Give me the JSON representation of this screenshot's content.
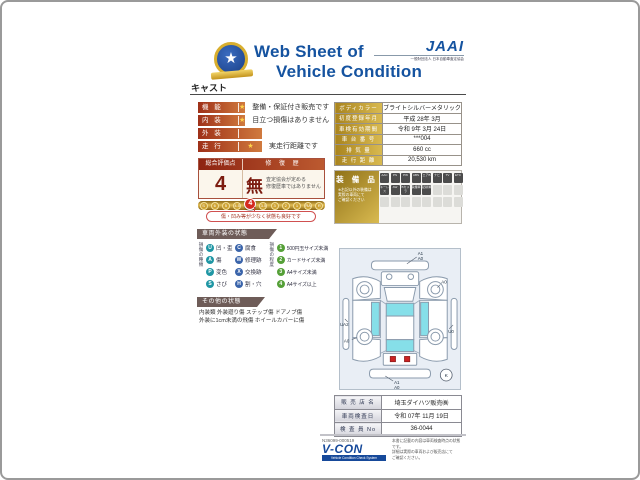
{
  "header": {
    "title_line1": "Web Sheet of",
    "title_line2": "Vehicle Condition",
    "jaai_mark": "JAAI",
    "jaai_sub": "一般財団法人 日本自動車査定協会",
    "model_name": "キャスト"
  },
  "ratings": [
    {
      "label": "機 能",
      "star": "★",
      "desc": "整備・保証付き販売です"
    },
    {
      "label": "内 装",
      "star": "★",
      "desc": "目立つ損傷はありません"
    },
    {
      "label": "外 装",
      "star": "",
      "desc": ""
    },
    {
      "label": "走 行",
      "star": "★",
      "desc": "実走行距離です"
    }
  ],
  "evaluation": {
    "score_header": "総合評価点",
    "repair_header": "修 復 歴",
    "score": "4",
    "repair_value": "無",
    "repair_note1": "査定協会が定める",
    "repair_note2": "修復歴車ではありません",
    "scale": [
      "S",
      "6",
      "5",
      "4.5",
      "4",
      "3.5",
      "3",
      "2",
      "1",
      "RA",
      "R"
    ],
    "selected_grade": "4",
    "note": "傷・凹み等が少なく状態も良好です"
  },
  "vehicle_info": {
    "rows": [
      {
        "label": "ボディカラー",
        "value": "ブライトシルバーメタリック"
      },
      {
        "label": "初度登録年月",
        "value": "平成 28年 3月"
      },
      {
        "label": "車検有効期間",
        "value": "令和 9年 3月 24日"
      },
      {
        "label": "車 台 番 号",
        "value": "***004"
      },
      {
        "label": "排  気  量",
        "value": "660 cc"
      },
      {
        "label": "走 行 距 離",
        "value": "20,530 km"
      }
    ]
  },
  "equipment": {
    "title": "装 備 品",
    "note1": "※右記以外の装備は",
    "note2": "実際の車両にて",
    "note3": "ご確認ください",
    "badges_row1": [
      "AAC",
      "PS",
      "PW",
      "ABS",
      "エアB",
      "ナビ",
      "TV",
      "ETC"
    ],
    "badges_row2": [
      "キーレス",
      "AW",
      "Bカメラ",
      "禁煙車",
      "記録簿"
    ]
  },
  "exterior_legend": {
    "section_title": "車両外装の状態",
    "type_header": "損傷の種類",
    "types_col1": [
      {
        "code": "U",
        "label": "凹・歪"
      },
      {
        "code": "A",
        "label": "傷"
      },
      {
        "code": "P",
        "label": "変色"
      },
      {
        "code": "S",
        "label": "さび"
      }
    ],
    "types_col2": [
      {
        "code": "C",
        "label": "腐食"
      },
      {
        "code": "W",
        "label": "修理跡"
      },
      {
        "code": "X",
        "label": "交換跡"
      },
      {
        "code": "H",
        "label": "割・穴"
      }
    ],
    "degree_header": "損傷の程度",
    "degrees": [
      {
        "code": "1",
        "label": "500円玉サイズ未満"
      },
      {
        "code": "2",
        "label": "カードサイズ未満"
      },
      {
        "code": "3",
        "label": "A4サイズ未満"
      },
      {
        "code": "4",
        "label": "A4サイズ以上"
      }
    ]
  },
  "other_condition": {
    "section_title": "その他の状態",
    "line1": "内装類 外装廻り傷 ステップ傷 ドアノブ傷",
    "line2": "外装に1cm未満の飛傷 ホイールカバーに傷"
  },
  "diagram": {
    "front_label_1": "A1",
    "front_label_2": "A0",
    "front_right_wheel": "A0",
    "left_side": "UA2",
    "right_side": "U0",
    "rear_left_wheel": "A0",
    "rear_label_1": "A1",
    "rear_label_2": "A0",
    "corner_mark": "K"
  },
  "dealer": {
    "rows": [
      {
        "label": "販 売 店 名",
        "value": "埼玉ダイハツ販売㈱"
      },
      {
        "label": "車両検査日",
        "value": "令和 07年 11月 19日"
      },
      {
        "label": "検 査 員 No",
        "value": "36-0044"
      }
    ]
  },
  "footer": {
    "serial": "N36099-000519",
    "vcon": "V-CON",
    "vcon_sub": "Vehicle Condition Check System",
    "fine1": "本書に記載の内容は車両検査時点の状態です。",
    "fine2": "詳細は実際の車両および販売店にて",
    "fine3": "ご確認ください。"
  },
  "colors": {
    "accent_blue": "#1553a0",
    "bar_red": "#9e3018",
    "gold": "#c49a2e",
    "selected_red": "#d42a20",
    "window_cyan": "#86dfe9"
  }
}
